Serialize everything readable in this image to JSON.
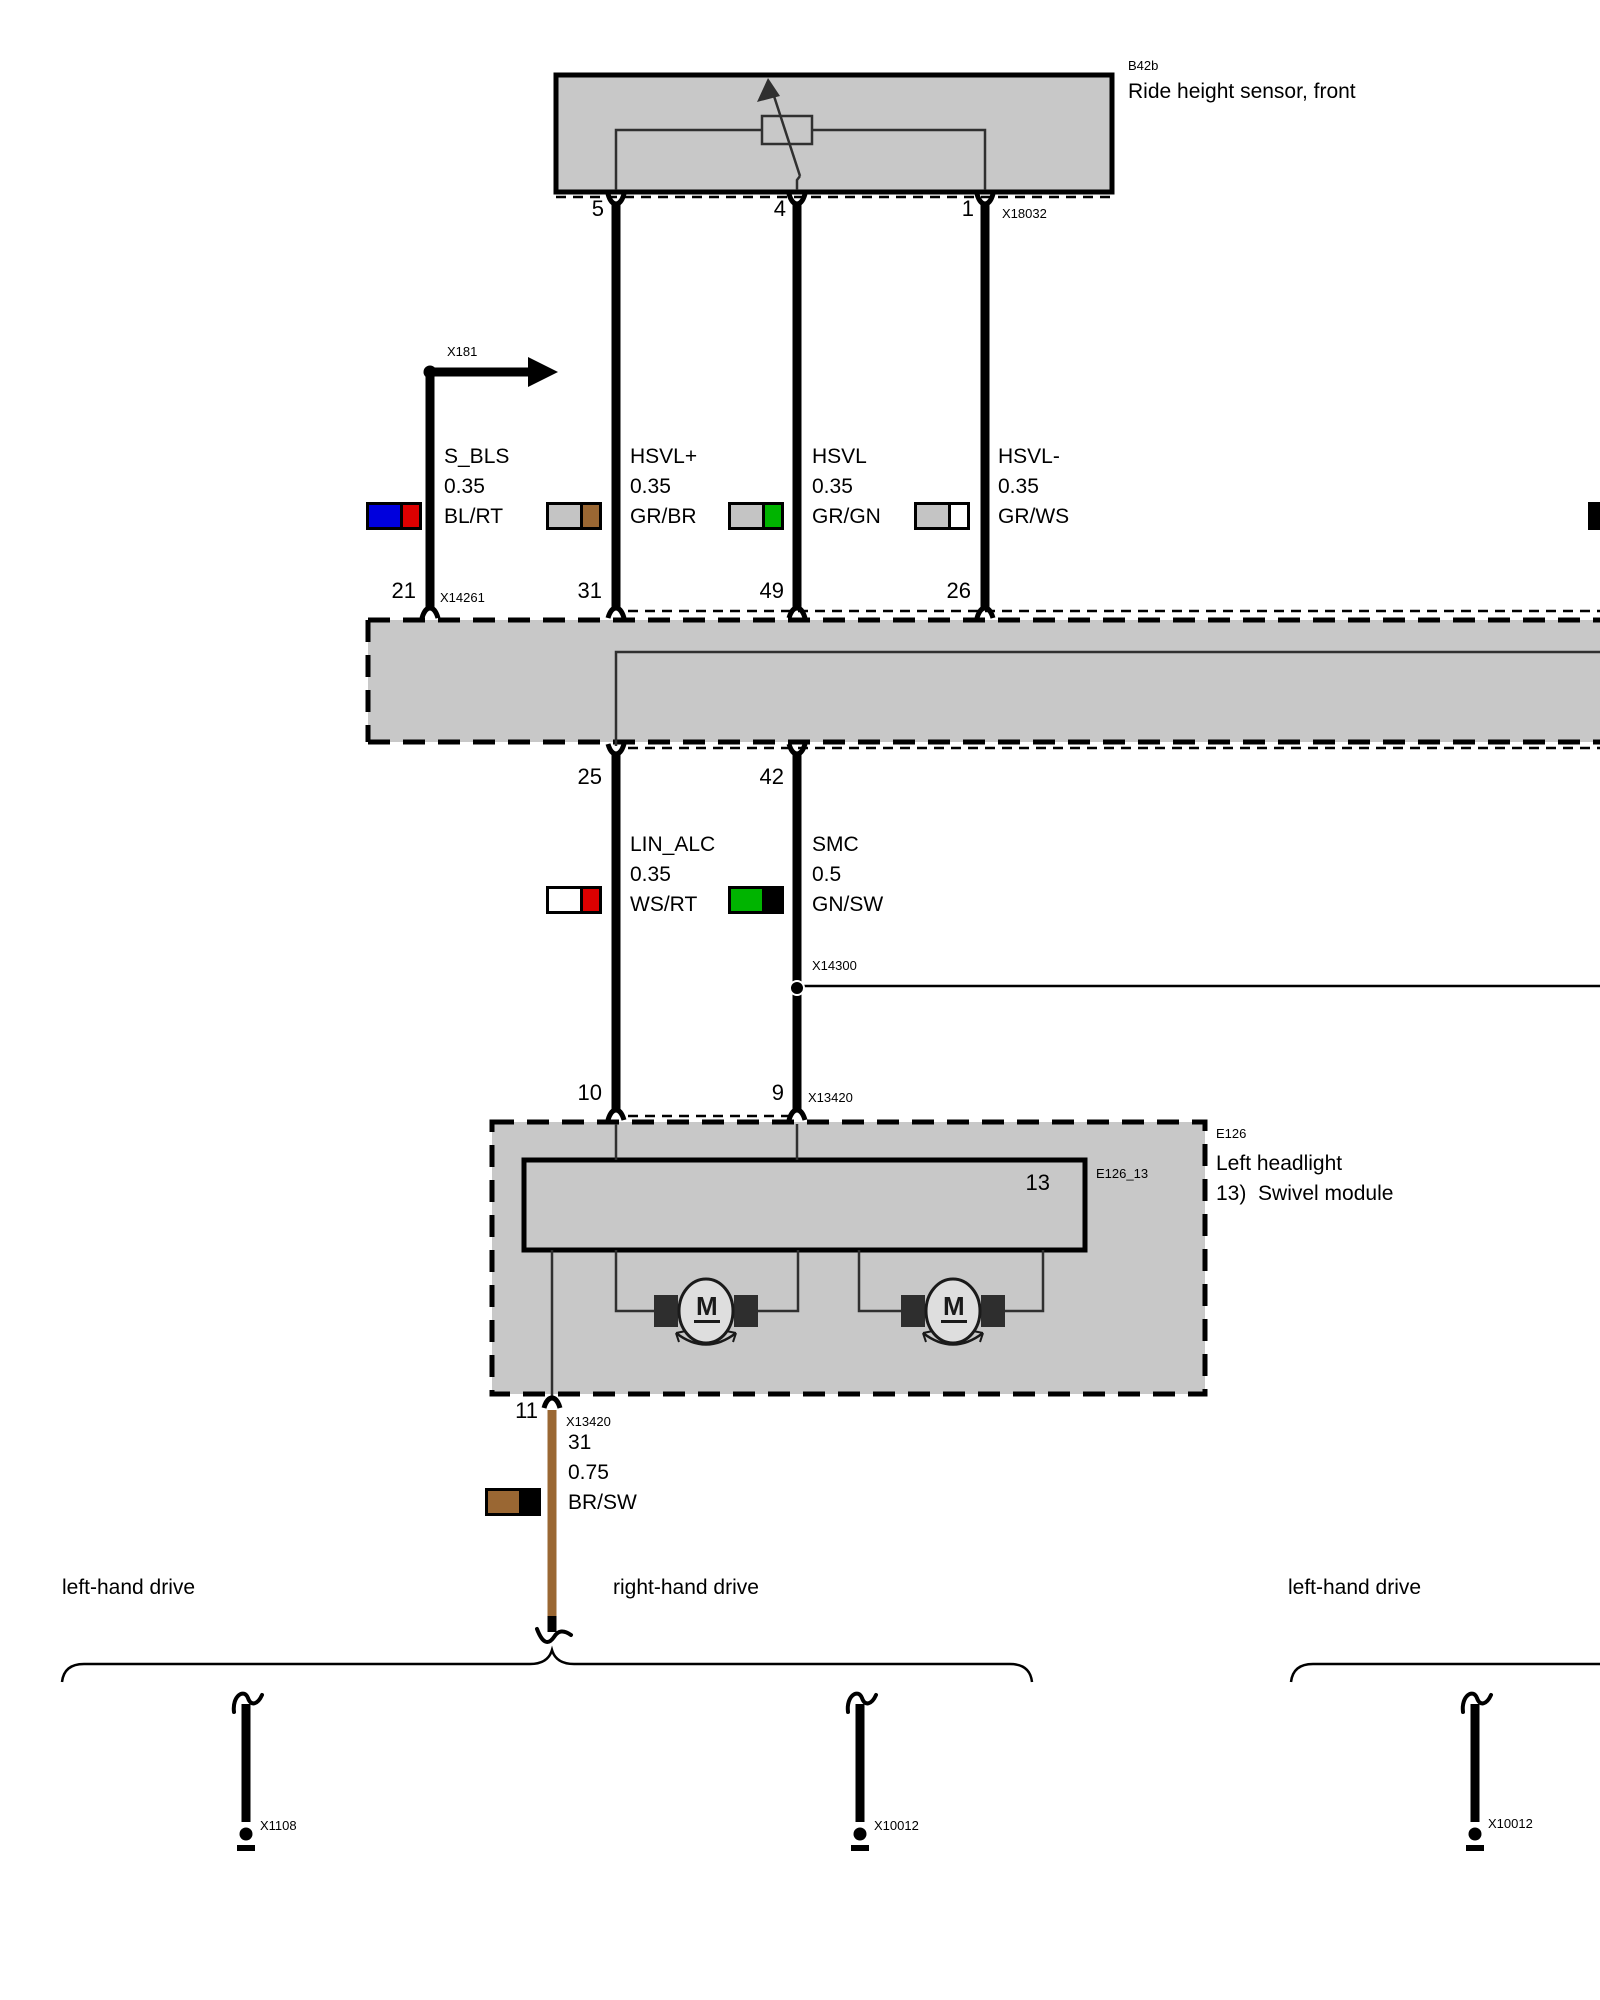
{
  "sensor": {
    "code": "B42b",
    "name": "Ride height sensor, front",
    "connector": "X18032",
    "pins": [
      {
        "n": "5"
      },
      {
        "n": "4"
      },
      {
        "n": "1"
      }
    ]
  },
  "branch_x181": {
    "label": "X181"
  },
  "upper_wires": [
    {
      "signal": "S_BLS",
      "size": "0.35",
      "color": "BL/RT",
      "module_pin": "21",
      "module_connector": "X14261",
      "swatch_main": "#0000dd",
      "swatch_stripe": "#dd0000"
    },
    {
      "signal": "HSVL+",
      "size": "0.35",
      "color": "GR/BR",
      "module_pin": "31",
      "swatch_main": "#c4c4c4",
      "swatch_stripe": "#9a6733"
    },
    {
      "signal": "HSVL",
      "size": "0.35",
      "color": "GR/GN",
      "module_pin": "49",
      "swatch_main": "#c4c4c4",
      "swatch_stripe": "#00b400"
    },
    {
      "signal": "HSVL-",
      "size": "0.35",
      "color": "GR/WS",
      "module_pin": "26",
      "swatch_main": "#c4c4c4",
      "swatch_stripe": "#ffffff"
    }
  ],
  "lower_wires": [
    {
      "module_pin": "25",
      "signal": "LIN_ALC",
      "size": "0.35",
      "color": "WS/RT",
      "device_pin": "10",
      "swatch_main": "#ffffff",
      "swatch_stripe": "#dd0000"
    },
    {
      "module_pin": "42",
      "signal": "SMC",
      "size": "0.5",
      "color": "GN/SW",
      "device_pin": "9",
      "junction": "X14300",
      "swatch_main": "#00b400",
      "swatch_stripe": "#000000"
    }
  ],
  "headlight": {
    "code": "E126",
    "name": "Left headlight",
    "note": "13)  Swivel module",
    "connector": "X13420",
    "submodule_code": "E126_13",
    "submodule_pin": "13",
    "motor_label": "M"
  },
  "ground_branch": {
    "pin": "11",
    "connector": "X13420",
    "signal": "31",
    "size": "0.75",
    "color": "BR/SW",
    "wire_color_hex": "#9a6733",
    "swatch_main": "#9a6733",
    "swatch_stripe": "#000000"
  },
  "variant_labels": [
    "left-hand drive",
    "right-hand drive",
    "left-hand drive"
  ],
  "grounds": [
    {
      "id": "X1108"
    },
    {
      "id": "X10012"
    },
    {
      "id": "X10012"
    }
  ],
  "palette": {
    "module_fill": "#c8c8c8",
    "wire_black": "#000000",
    "thin_line": "#303030"
  }
}
